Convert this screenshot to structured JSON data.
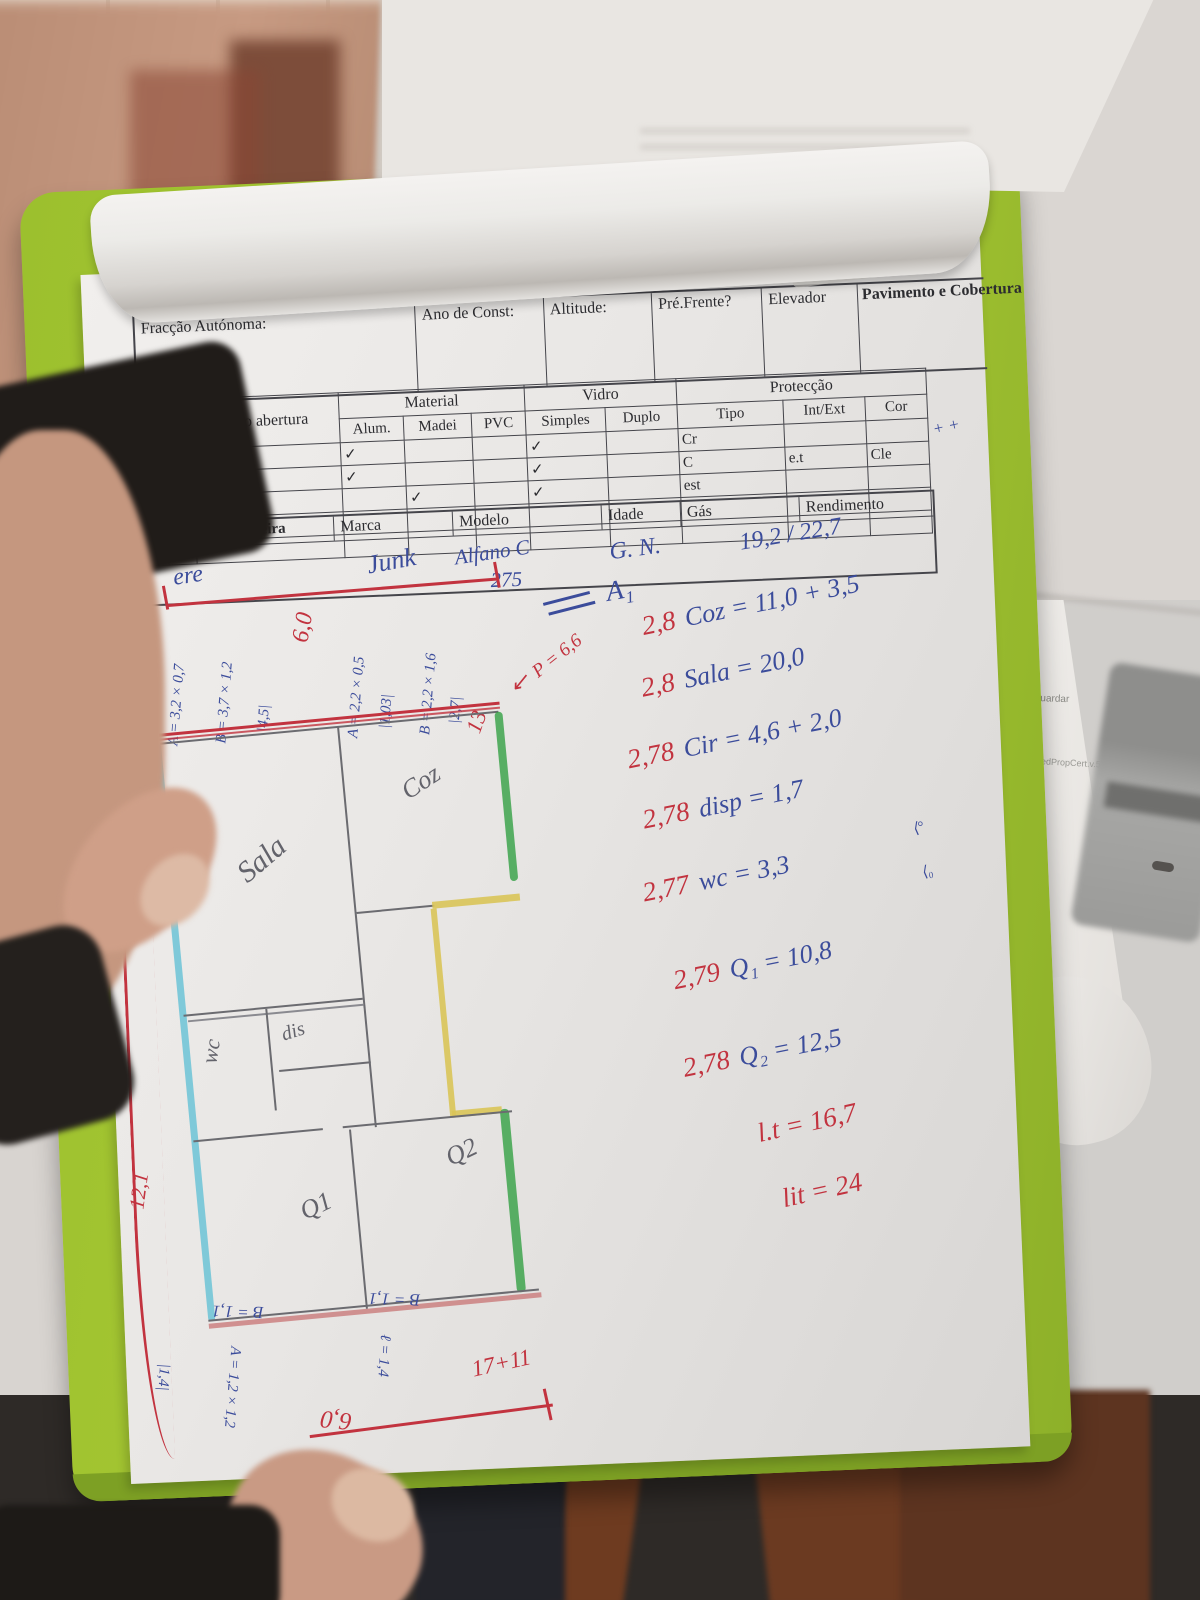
{
  "colors": {
    "board_green": "#a4c631",
    "pen_red": "#c2333f",
    "pen_blue": "#3b4c9b",
    "pencil": "#63636b",
    "hl_cyan": "#6cc3d6",
    "hl_green": "#33a043",
    "hl_yellow": "#d9c458"
  },
  "side_paper": {
    "line1": "ambos guardar",
    "line2": "MobileDedPropCert.v.5"
  },
  "form": {
    "handwritten_title": "Ps. Cat. Orlando",
    "header": {
      "fraccao": "Fracção Autónoma:",
      "ano": "Ano de Const:",
      "altitude": "Altitude:",
      "pre_frente": "Pré.Frente?",
      "elevador": "Elevador",
      "pavimento": "Pavimento e Cobertura"
    },
    "table": {
      "col_no": "Nº",
      "col_face": "face",
      "col_tipo": "Tipo abertura",
      "group_material": "Material",
      "group_vidro": "Vidro",
      "group_proteccao": "Protecção",
      "sub_alum": "Alum.",
      "sub_madei": "Madei",
      "sub_pvc": "PVC",
      "sub_simples": "Simples",
      "sub_duplo": "Duplo",
      "sub_tipo": "Tipo",
      "sub_intext": "Int/Ext",
      "sub_cor": "Cor",
      "rows": [
        {
          "no": "A",
          "face": "e",
          "tipo": "Fixo",
          "alum": "✓",
          "madei": "",
          "pvc": "",
          "simples": "✓",
          "duplo": "",
          "ptipo": "Cr",
          "intext": "",
          "cor": ""
        },
        {
          "no": "B",
          "face": "J",
          "tipo": "Corr",
          "alum": "✓",
          "madei": "",
          "pvc": "",
          "simples": "✓",
          "duplo": "",
          "ptipo": "C",
          "intext": "e.t",
          "cor": "Cle"
        },
        {
          "no": "C",
          "face": "e",
          "tipo": "Bat",
          "alum": "",
          "madei": "✓",
          "pvc": "",
          "simples": "✓",
          "duplo": "",
          "ptipo": "est",
          "intext": "",
          "cor": ""
        }
      ],
      "margin_note": "+ +"
    },
    "boiler": {
      "label": "Esquentador/caldeira",
      "marca": "Marca",
      "modelo": "Modelo",
      "idade": "Idade",
      "gas": "Gás",
      "rendimento": "Rendimento",
      "values": {
        "tipo": "ere",
        "marca": "Junk",
        "modelo": "Alfano C",
        "modelo2": "275",
        "gas": "G. N.",
        "rendimento": "19,2 / 22,7"
      }
    },
    "a1_note": "A₁"
  },
  "calcs": {
    "lines": [
      {
        "coef": "2,8",
        "expr": "Coz = 11,0 + 3,5"
      },
      {
        "coef": "2,8",
        "expr": "Sala = 20,0"
      },
      {
        "coef": "2,78",
        "expr": "Cir = 4,6 + 2,0"
      },
      {
        "coef": "2,78",
        "expr": "disp = 1,7"
      },
      {
        "coef": "2,77",
        "expr": "wc = 3,3"
      },
      {
        "coef": "2,79",
        "expr": "Q₁ = 10,8"
      },
      {
        "coef": "2,78",
        "expr": "Q₂ = 12,5"
      }
    ],
    "wc_mark1": "⟨°",
    "wc_mark2": "⟨₀",
    "totals": {
      "t1": "l.t = 16,7",
      "t2": "lit = 24"
    }
  },
  "plan": {
    "rooms": {
      "sala": "Sala",
      "coz": "Coz",
      "wc": "wc",
      "dis": "dis",
      "q1": "Q1",
      "q2": "Q2"
    },
    "dims_top": [
      "|2,5|",
      "A = 3,2 × 0,7",
      "B = 3,7 × 1,2",
      "|4,5|",
      "6,0",
      "A = 2,2 × 0,5",
      "|1,03|",
      "B = 2,2 × 1,6",
      "|2,7|",
      "13"
    ],
    "p_note": "P = 6,6",
    "arrow": "↙",
    "dim_left": "12,1",
    "dims_bottom": {
      "b1": "B = 1,1",
      "b2": "B = 1,1",
      "l14": "ℓ = 1,4",
      "a12": "A = 1,2 × 1,2",
      "d14": "|1,4|",
      "six": "6,0",
      "sum": "17+11"
    }
  }
}
